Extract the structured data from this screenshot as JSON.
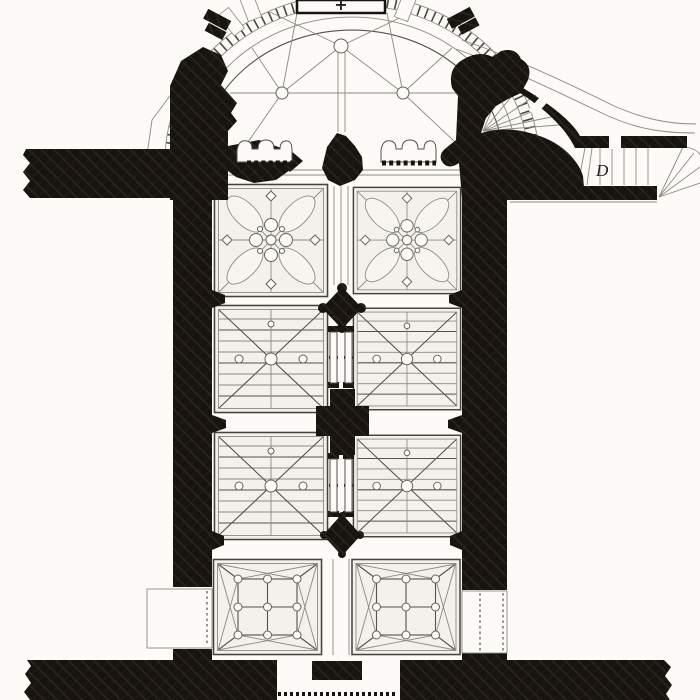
{
  "figure": {
    "subject": "church floor plan drawing",
    "labels": {
      "staircase": "D",
      "altar_cross": "+"
    },
    "colors": {
      "poche_ink": "#17130e",
      "poche_hatch": "#3d372e",
      "line_dark": "#44403a",
      "line_light": "#8d8982",
      "paper": "#fcfbf8",
      "bay_fill": "#f3f1ec"
    }
  }
}
